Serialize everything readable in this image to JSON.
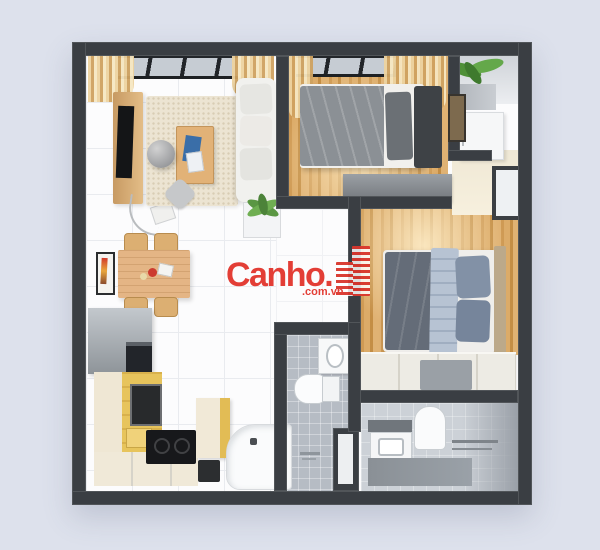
{
  "watermark": {
    "brand": "Canho.",
    "suffix": ".com.vn",
    "color": "#e2342c",
    "icon": "building-stripes-icon"
  },
  "palette": {
    "background": "#dde1ec",
    "wall": "#3a3e43",
    "floor_white": "#fcfcfd",
    "wood_floor": "#d3a05c",
    "rug_cream": "#ece4d2",
    "bath_tile_gray": "#b6bcc4",
    "kitchen_yellow": "#e7c45c",
    "bed_gray": "#8b9095",
    "bed_blue_throw": "#b7c3d3",
    "accent_red": "#e2342c"
  },
  "scene": {
    "type": "3d-apartment-floor-plan",
    "rooms": [
      "living-room",
      "dining-area",
      "small-bedroom",
      "master-bedroom",
      "kitchen",
      "bathroom-1",
      "bathroom-2",
      "utility-balcony"
    ]
  }
}
